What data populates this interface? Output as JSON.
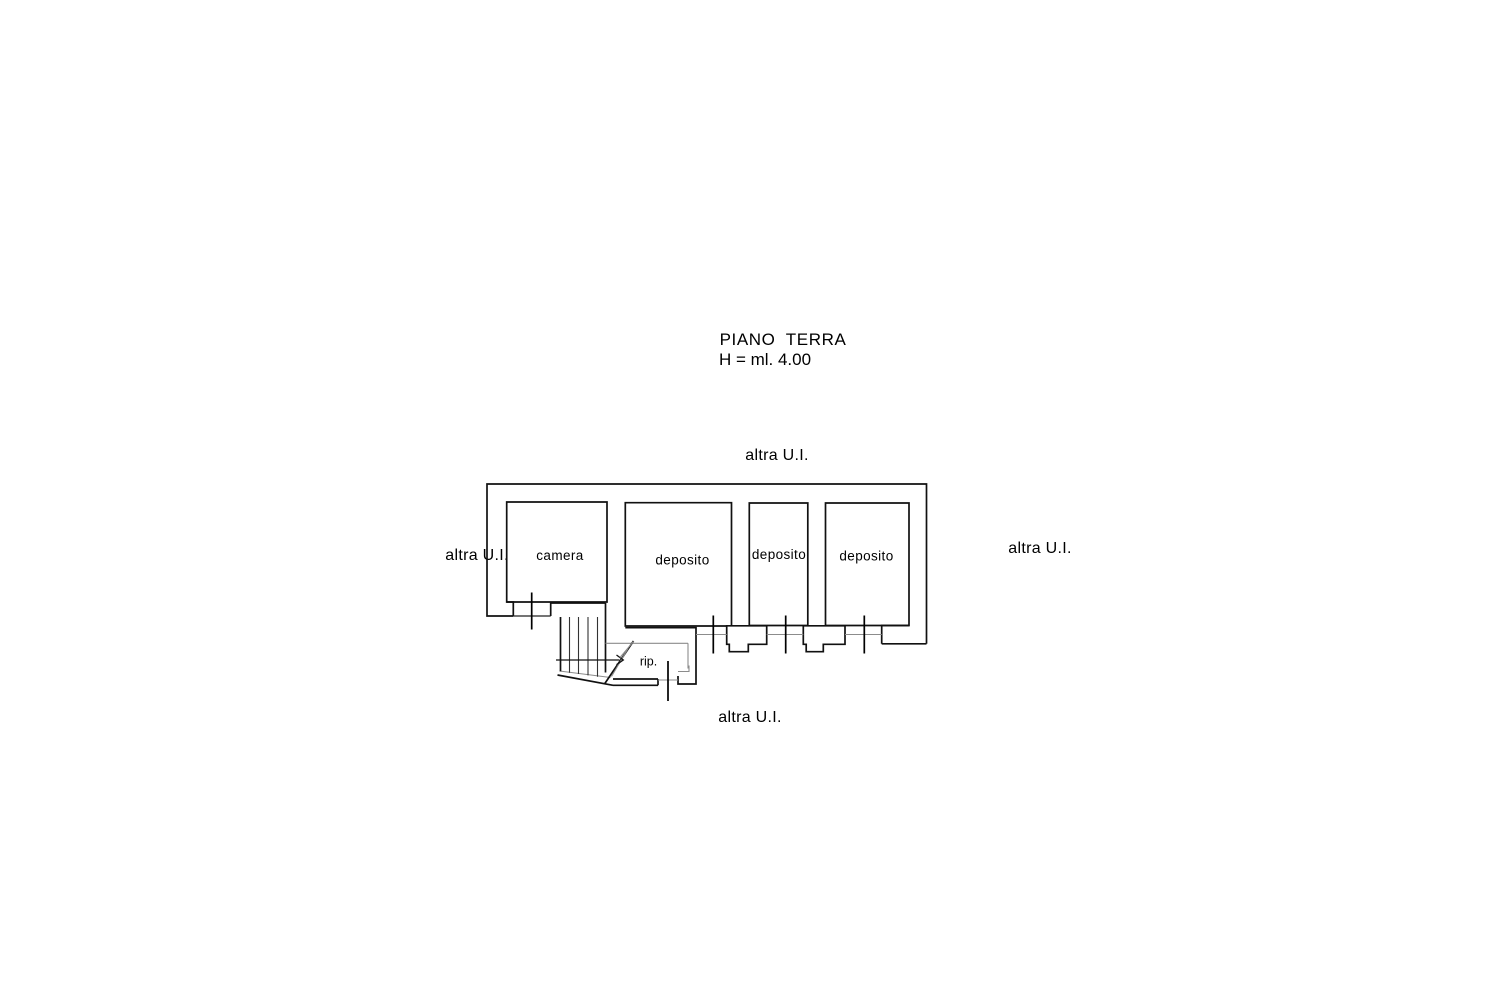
{
  "title": {
    "main": "PIANO  TERRA",
    "height_note": "H = ml. 4.00"
  },
  "plan": {
    "rooms": [
      {
        "id": "camera",
        "label": "camera"
      },
      {
        "id": "deposito-1",
        "label": "deposito"
      },
      {
        "id": "deposito-2",
        "label": "deposito"
      },
      {
        "id": "deposito-3",
        "label": "deposito"
      },
      {
        "id": "ripostiglio",
        "label": "rip."
      }
    ],
    "adjacent_units": {
      "top": "altra U.I.",
      "left": "altra U.I.",
      "right": "altra U.I.",
      "bottom": "altra U.I."
    },
    "colors": {
      "wall": "#111111",
      "thin_line": "#8c8c8c",
      "text": "#000000",
      "background": "#ffffff"
    }
  }
}
